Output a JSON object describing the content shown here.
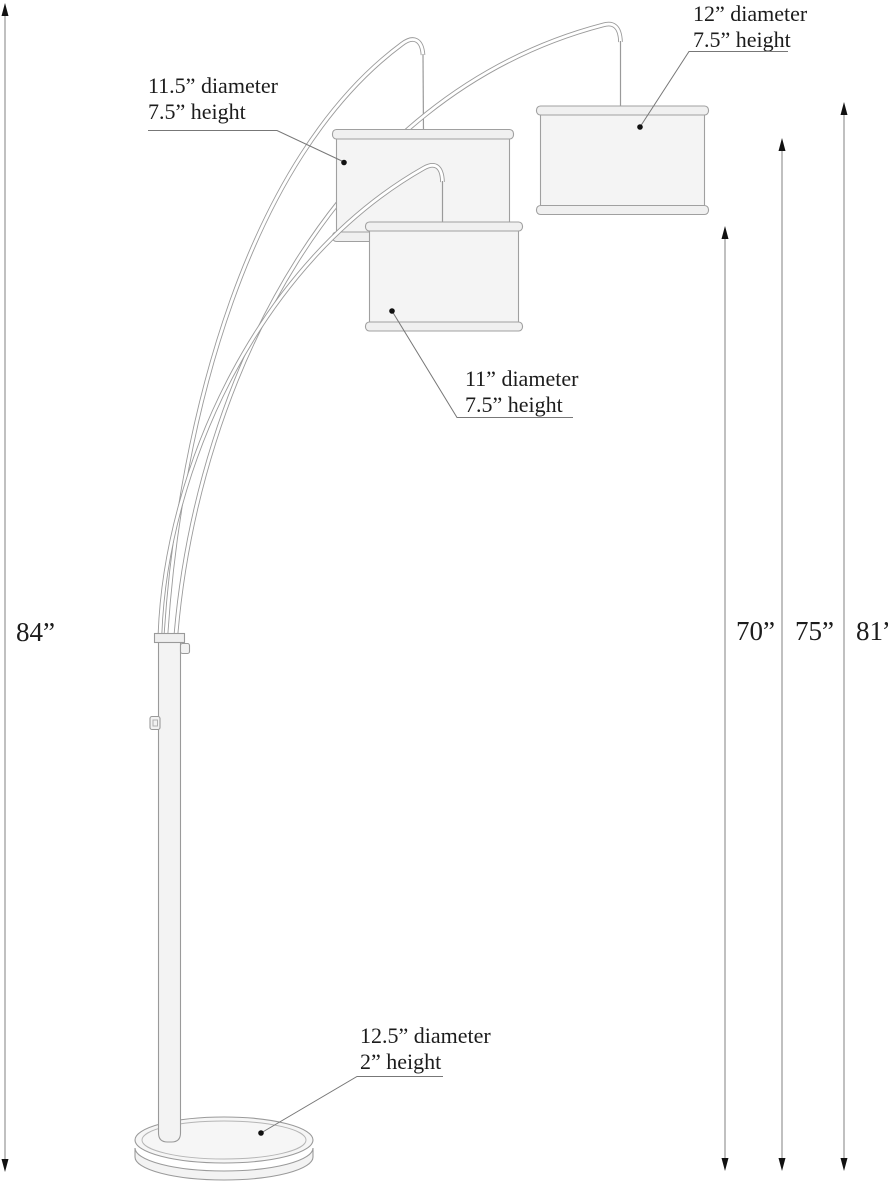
{
  "diagram": {
    "type": "product-dimension-diagram",
    "product": "3-arm arc floor lamp",
    "labels": {
      "shade_left": {
        "l1": "11.5” diameter",
        "l2": "7.5” height"
      },
      "shade_right": {
        "l1": "12” diameter",
        "l2": "7.5” height"
      },
      "shade_center": {
        "l1": "11” diameter",
        "l2": "7.5” height"
      },
      "base": {
        "l1": "12.5” diameter",
        "l2": "2” height"
      }
    },
    "dimensions": {
      "overall": "84”",
      "arm_low": "70”",
      "arm_mid": "75”",
      "arm_high": "81”"
    },
    "colors": {
      "background": "#ffffff",
      "outline": "#9a9a9a",
      "leader": "#777777",
      "dimension_line": "#808080",
      "arrowhead": "#111111",
      "text": "#1c1c1c",
      "fill_light": "#f5f5f5"
    }
  }
}
